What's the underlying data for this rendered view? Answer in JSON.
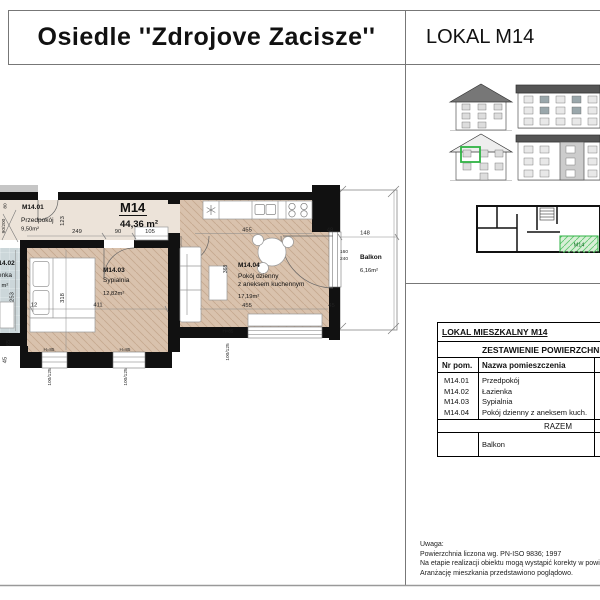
{
  "header": {
    "project_title": "Osiedle ''Zdrojove Zacisze''",
    "unit_title": "LOKAL M14"
  },
  "plan": {
    "unit": {
      "code": "M14",
      "area": "44,36 m²"
    },
    "rooms": {
      "hall": {
        "code": "M14.01",
        "name": "Przedpokój",
        "area": "9,50m²"
      },
      "bath": {
        "code": "M14.02",
        "name": "Łazienka",
        "area": "m²"
      },
      "bedroom": {
        "code": "M14.03",
        "name": "Sypialnia",
        "area": "12,82m²"
      },
      "living": {
        "code": "M14.04",
        "name_line1": "Pokój dzienny",
        "name_line2": "z aneksem kuchennym",
        "area": "17,19m²"
      },
      "balcony": {
        "name": "Balkon",
        "area": "6,16m²"
      }
    },
    "dims": {
      "hall_seg1": "249",
      "hall_door": "90",
      "hall_seg2": "105",
      "hall_depth": "123",
      "left_top": "80",
      "left_door": "90/200",
      "bed_small": "12",
      "bed_width": "411",
      "bed_depth": "318",
      "bath_depth": "253",
      "corner_a": "65",
      "corner_b": "45",
      "win1_size": "100/125",
      "win1_h": "H=85",
      "win2_size": "100/125",
      "win2_h": "H=85",
      "liv_top": "455",
      "liv_bottom": "455",
      "liv_depth": "368",
      "liv_win_size": "100/125",
      "liv_win_h": "H=85",
      "balc_width": "148",
      "balc_door_w": "160",
      "balc_door_h": "240",
      "balc_side": "45",
      "balc_corner": "48"
    }
  },
  "keyplan": {
    "unit_label": "M14"
  },
  "table": {
    "title": "LOKAL MIESZKALNY M14",
    "subtitle": "ZESTAWIENIE POWIERZCHNI",
    "col_no": "Nr pom.",
    "col_name": "Nazwa pomieszczenia",
    "rows": [
      {
        "no": "M14.01",
        "name": "Przedpokój"
      },
      {
        "no": "M14.02",
        "name": "Łazienka"
      },
      {
        "no": "M14.03",
        "name": "Sypialnia"
      },
      {
        "no": "M14.04",
        "name": "Pokój dzienny z aneksem kuch."
      }
    ],
    "total_label": "RAZEM",
    "balcony_label": "Balkon"
  },
  "notes": {
    "lines": [
      "Uwaga:",
      "Powierzchnia liczona wg. PN-ISO 9836; 1997",
      "Na etapie realizacji obiektu mogą wystąpić korekty w powierzchniach.",
      "Aranżację mieszkania przedstawiono poglądowo."
    ]
  },
  "colors": {
    "accent_green": "#2fb344",
    "wall_black": "#111111",
    "floor_wood": "#d9c2ad",
    "floor_bath": "#ccd7da"
  }
}
